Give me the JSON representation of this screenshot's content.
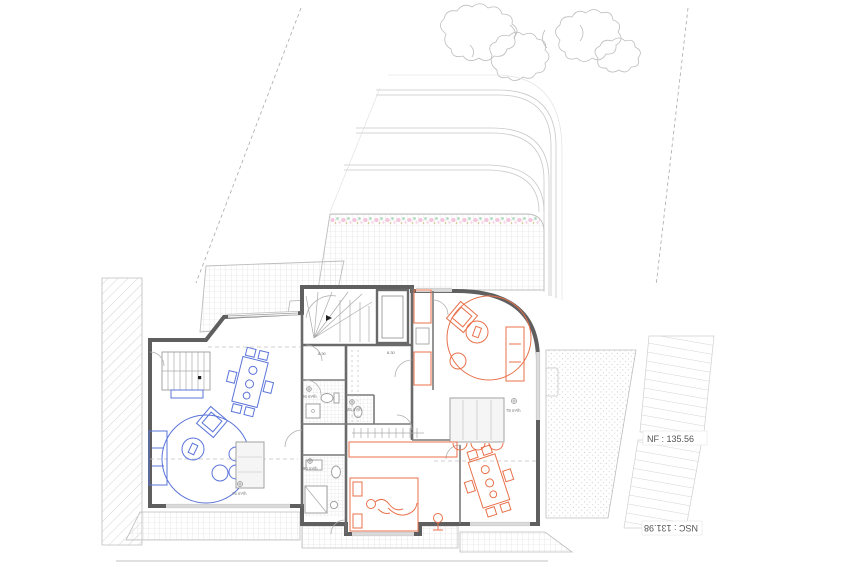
{
  "document": {
    "type": "architectural-floor-plan",
    "view": "ground-floor plan with two units and terraced garden"
  },
  "annotations": {
    "finished_floor_level": "NF : 135.56",
    "lower_ground_level": "NSC : 131.98",
    "stair_marker_a": "8.30",
    "stair_marker_b": "8.30",
    "vent_wc_left": "26 m³/h",
    "vent_wc_mid": "26 m³/h",
    "vent_bath_left": "90 m³/h",
    "vent_kitchen_left": "75 m³/h",
    "vent_kitchen_right": "78 m³/h"
  },
  "colors": {
    "unit_left_accent": "#5b74d9",
    "unit_right_accent": "#e8714b",
    "wall": "#5f5f5f",
    "light_line": "#c9c9c9",
    "grid_hatch": "#d9d9d9",
    "flower_pink": "#f3bcd9",
    "flower_green": "#a5d6b8",
    "label_text": "#555555",
    "paper": "#ffffff"
  }
}
